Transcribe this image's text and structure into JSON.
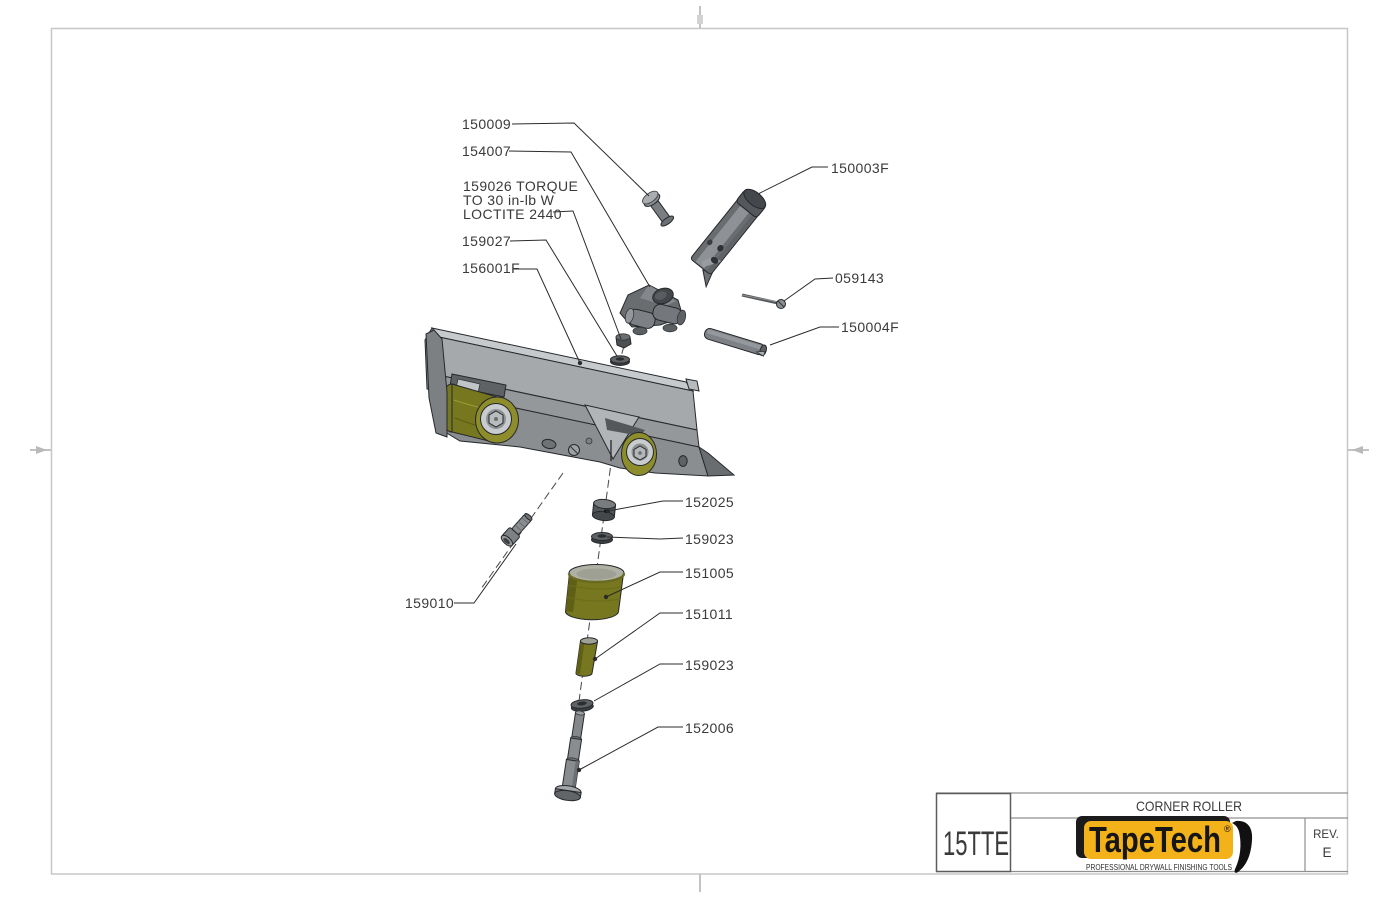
{
  "drawing": {
    "callouts": {
      "pin_150009": "150009",
      "bracket_154007": "154007",
      "torque_line1": "159026 TORQUE",
      "torque_line2": "TO 30 in-lb W",
      "torque_line3": "LOCTITE 2440",
      "washer_159027": "159027",
      "frame_156001F": "156001F",
      "tube_150003F": "150003F",
      "screw_059143": "059143",
      "pin_150004F": "150004F",
      "collar_152025": "152025",
      "washer_159023_upper": "159023",
      "roller_151005": "151005",
      "spacer_151011": "151011",
      "washer_159023_lower": "159023",
      "shaft_152006": "152006",
      "screw_159010": "159010"
    }
  },
  "title_block": {
    "model": "15TTE",
    "drawing_title": "CORNER ROLLER",
    "rev_label": "REV.",
    "rev_value": "E",
    "logo": {
      "brand": "TapeTech",
      "registered": "®",
      "tagline": "PROFESSIONAL DRYWALL FINISHING TOOLS"
    }
  },
  "colors": {
    "brand_gold": "#F3B21A",
    "olive_bright": "#8D8E2B",
    "olive_mid": "#76771F",
    "olive_dark": "#5A5B13",
    "metal_light": "#C7CACC",
    "metal_mid": "#A6A9AC",
    "metal_shade": "#8B8E91",
    "metal_dark": "#6A6D70",
    "metal_darkest": "#4C4F52",
    "silver": "#C9CCCE",
    "ink": "#2B2B2B",
    "label_ink": "#3A3A3C",
    "border_gray": "#C6C7C8"
  }
}
